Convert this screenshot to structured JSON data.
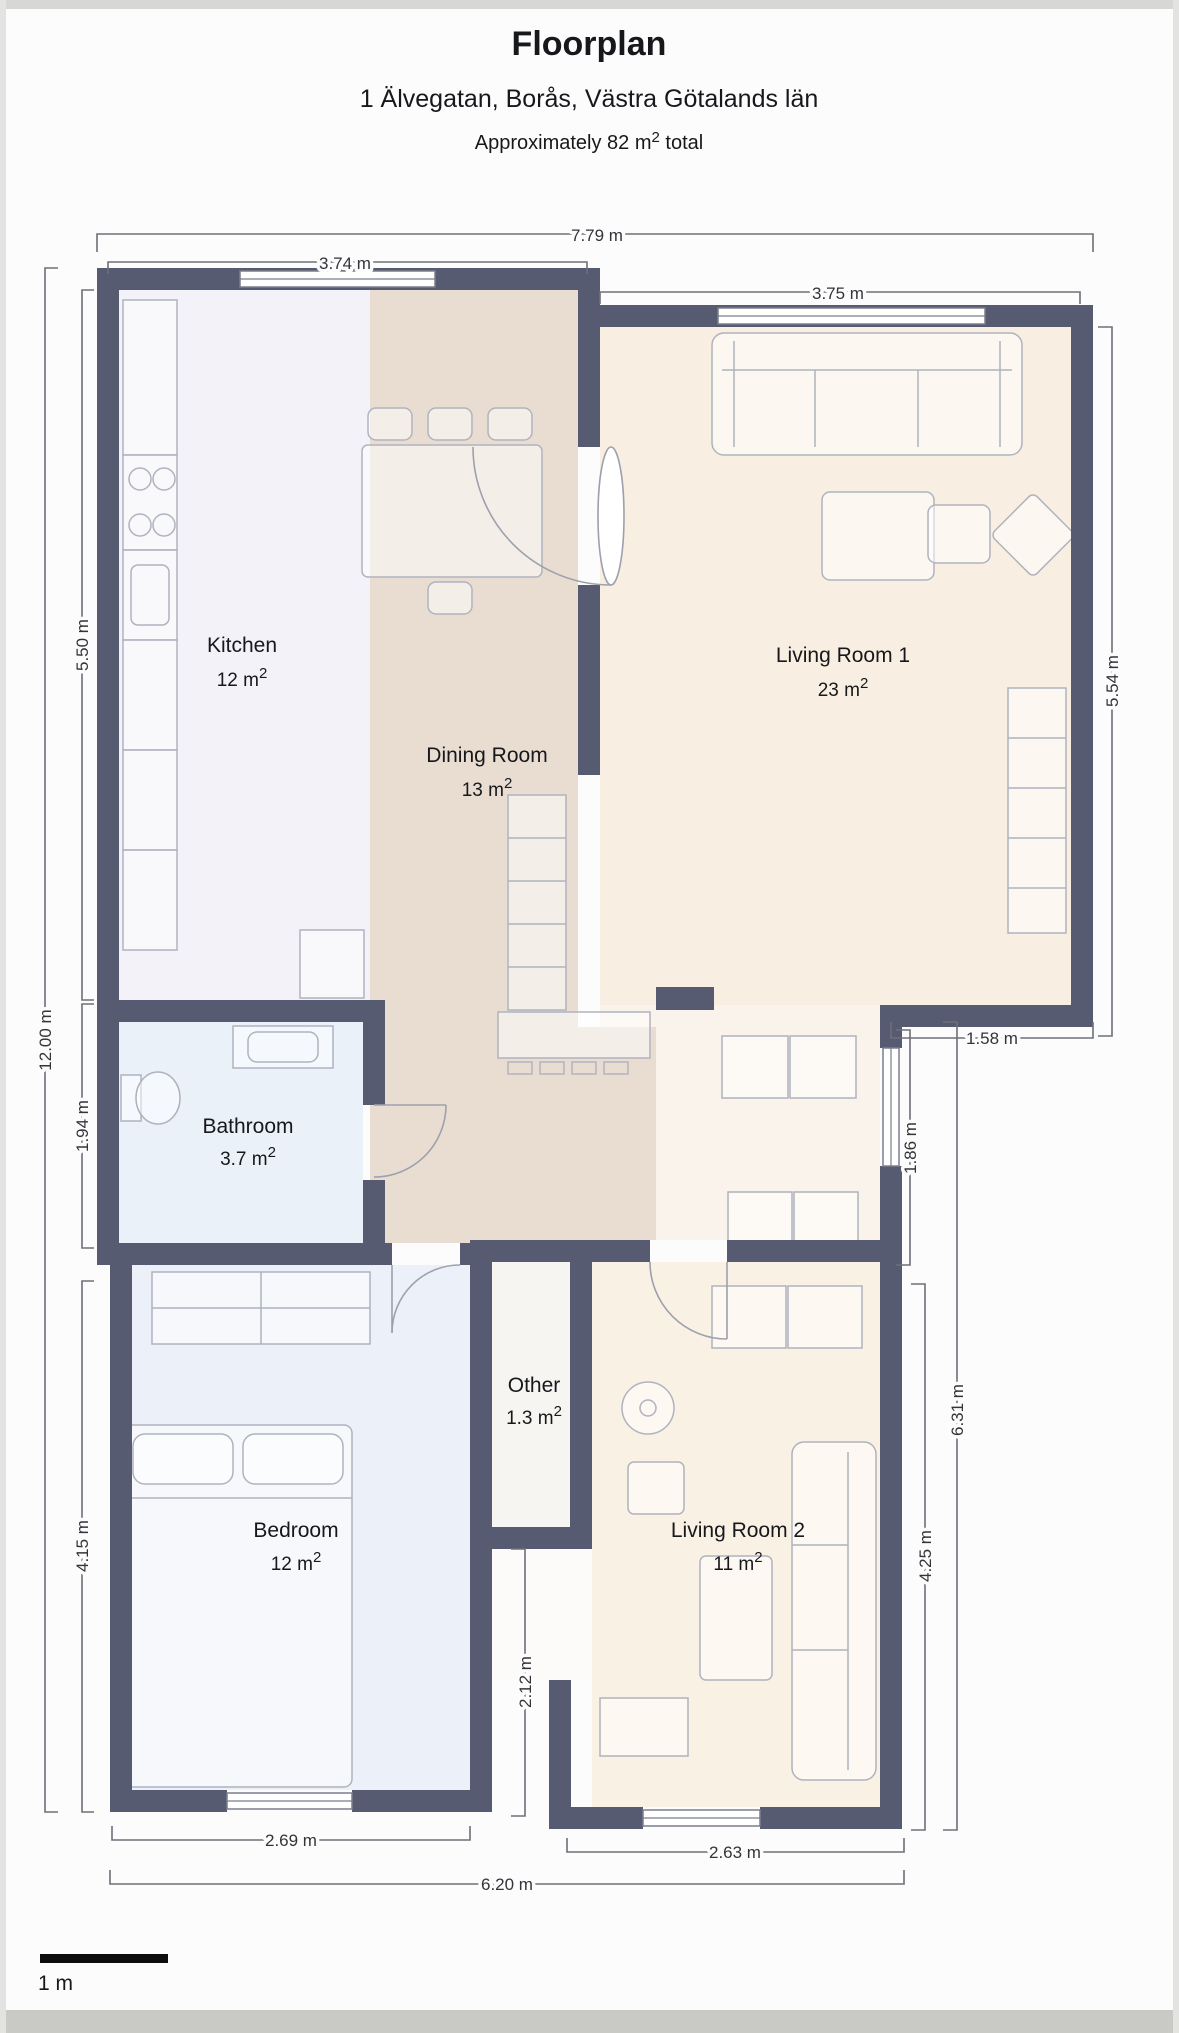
{
  "page": {
    "title": "Floorplan",
    "subtitle": "1 Älvegatan, Borås, Västra Götalands län",
    "total_prefix": "Approximately 82 m",
    "total_sup": "2",
    "total_suffix": " total"
  },
  "rooms": [
    {
      "name": "Kitchen",
      "area": "12 m",
      "sup": "2"
    },
    {
      "name": "Dining Room",
      "area": "13 m",
      "sup": "2"
    },
    {
      "name": "Living Room 1",
      "area": "23 m",
      "sup": "2"
    },
    {
      "name": "Bathroom",
      "area": "3.7 m",
      "sup": "2"
    },
    {
      "name": "Other",
      "area": "1.3 m",
      "sup": "2"
    },
    {
      "name": "Bedroom",
      "area": "12 m",
      "sup": "2"
    },
    {
      "name": "Living Room 2",
      "area": "11 m",
      "sup": "2"
    }
  ],
  "dimensions": {
    "top_total": "7.79 m",
    "top_left": "3.74 m",
    "top_right": "3.75 m",
    "left_total": "12.00 m",
    "left_kitchen": "5.50 m",
    "left_bathroom": "1.94 m",
    "left_bedroom": "4.15 m",
    "right_living1": "5.54 m",
    "right_step": "1.58 m",
    "right_hall": "1.86 m",
    "right_total": "6.31 m",
    "right_living2": "4.25 m",
    "mid_passage": "2.12 m",
    "bottom_bedroom": "2.69 m",
    "bottom_living2": "2.63 m",
    "bottom_total": "6.20 m"
  },
  "scale_bar": {
    "label": "1 m"
  },
  "colors": {
    "wall": "#575b72",
    "kitchen": "#f2f2f8",
    "dining": "#e9ddd1",
    "living1": "#f8efe2",
    "hall": "#faf3eb",
    "bathroom": "#eaf1f8",
    "bedroom": "#ecf1f9",
    "living2": "#faf1e5",
    "other": "#f6f5f1"
  }
}
